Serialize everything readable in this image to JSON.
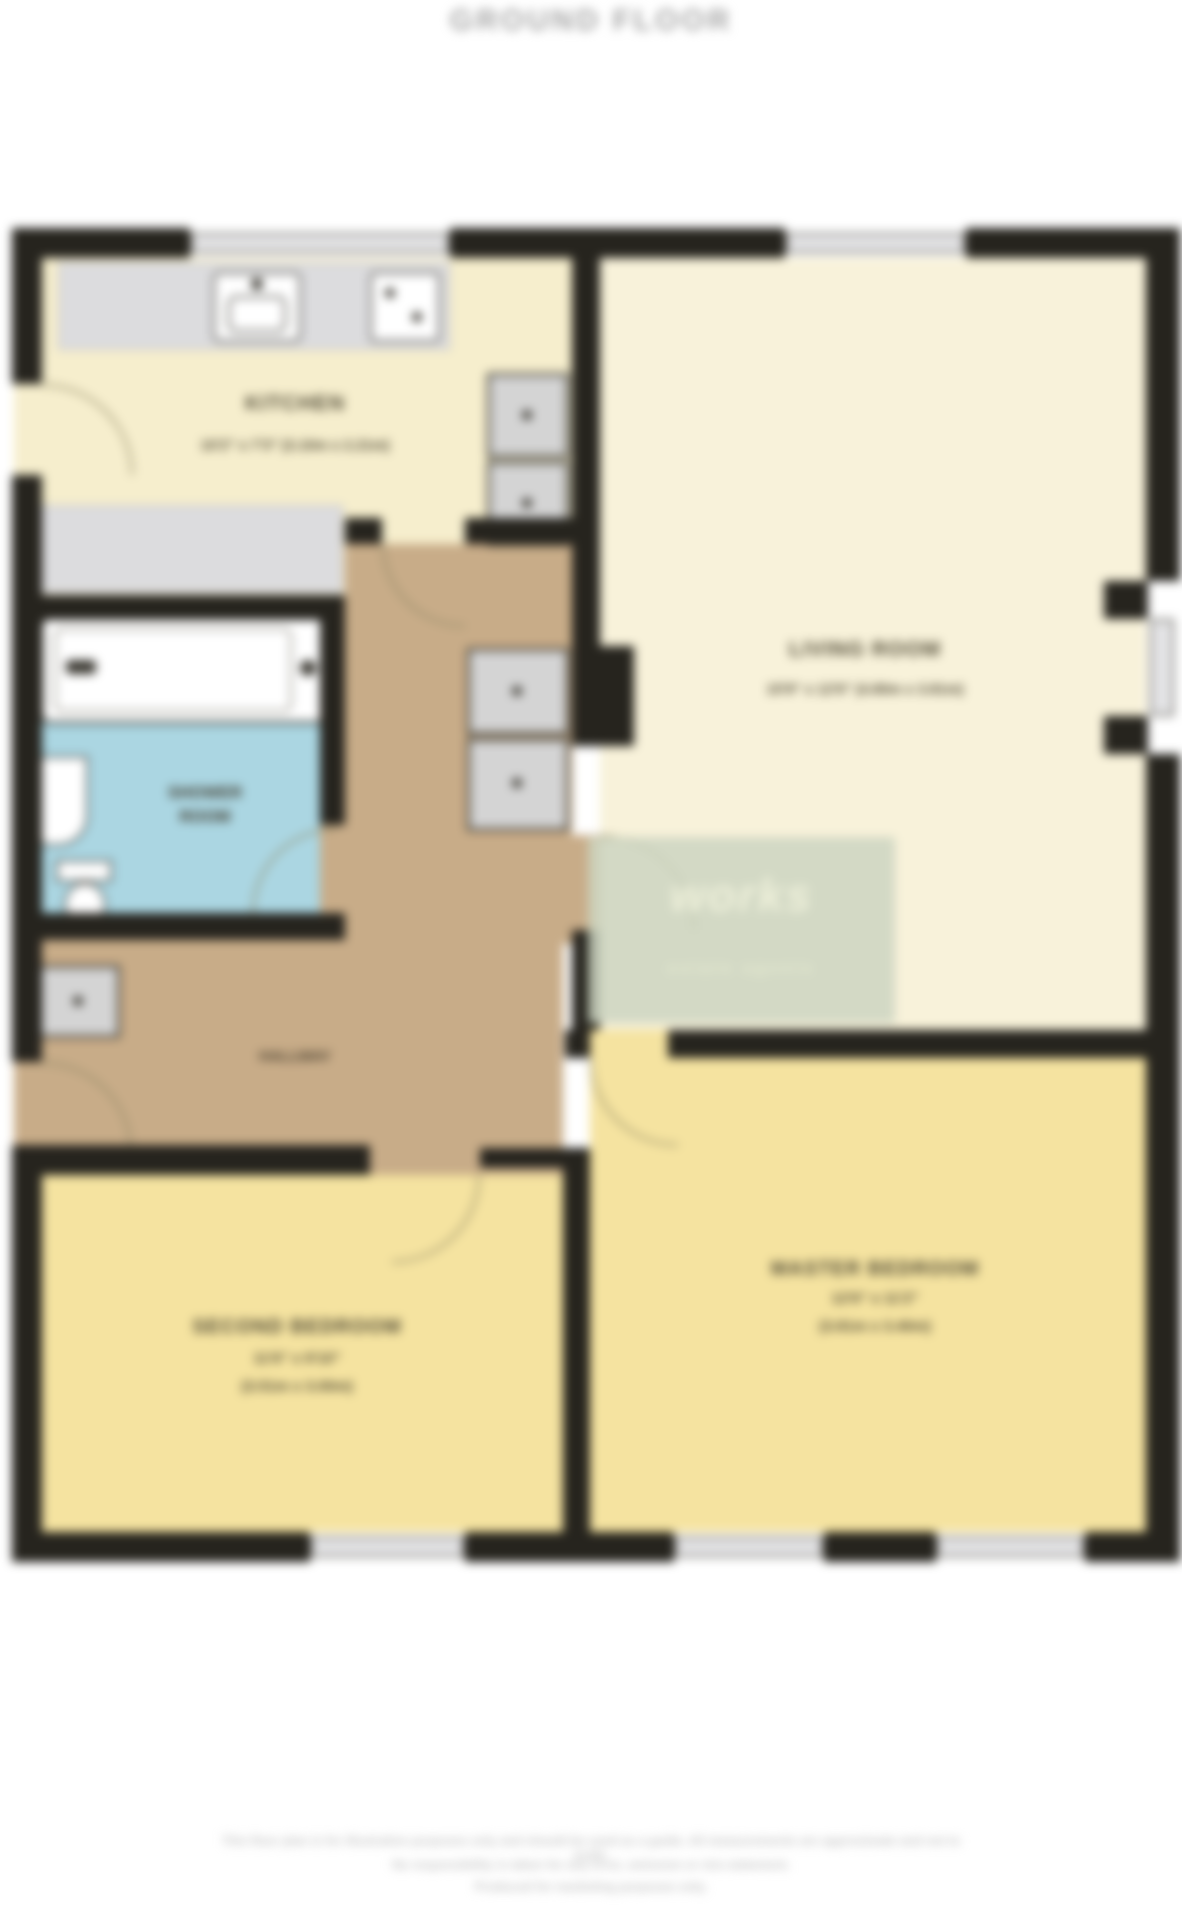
{
  "title": "GROUND FLOOR",
  "rooms": {
    "kitchen": {
      "name": "KITCHEN",
      "dims": "10'2\" x 7'3\" (3.10m x 2.21m)"
    },
    "living": {
      "name": "LIVING ROOM",
      "dims": "15'9\" x 12'6\" (4.80m x 3.81m)"
    },
    "shower": {
      "name_line1": "SHOWER",
      "name_line2": "ROOM"
    },
    "hall": {
      "name": "HALLWAY"
    },
    "master": {
      "name": "MASTER BEDROOM",
      "dims_imperial": "12'6\" x 11'2\"",
      "dims_metric": "(3.81m x 3.40m)"
    },
    "bedroom2": {
      "name": "SECOND BEDROOM",
      "dims_imperial": "11'6\" x 9'10\"",
      "dims_metric": "(3.51m x 3.00m)"
    }
  },
  "watermark": {
    "line1": "works",
    "line2": "estate agents"
  },
  "disclaimer": {
    "line1": "This floor plan is for illustrative purposes only and should be used as a guide. All measurements are approximate and not to scale.",
    "line2": "No responsibility is taken for any error, omission or mis-statement.",
    "line3": "Produced for marketing purposes only."
  },
  "colors": {
    "wall": "#26241e",
    "kitchen_floor": "#f6eecd",
    "living_floor": "#f8f2da",
    "hall_floor": "#c8ac88",
    "bath_floor": "#abd6e2",
    "bedroom_floor": "#f5e3a0",
    "watermark_green": "#cdd5c1",
    "title_gray": "#a6a6a6"
  }
}
